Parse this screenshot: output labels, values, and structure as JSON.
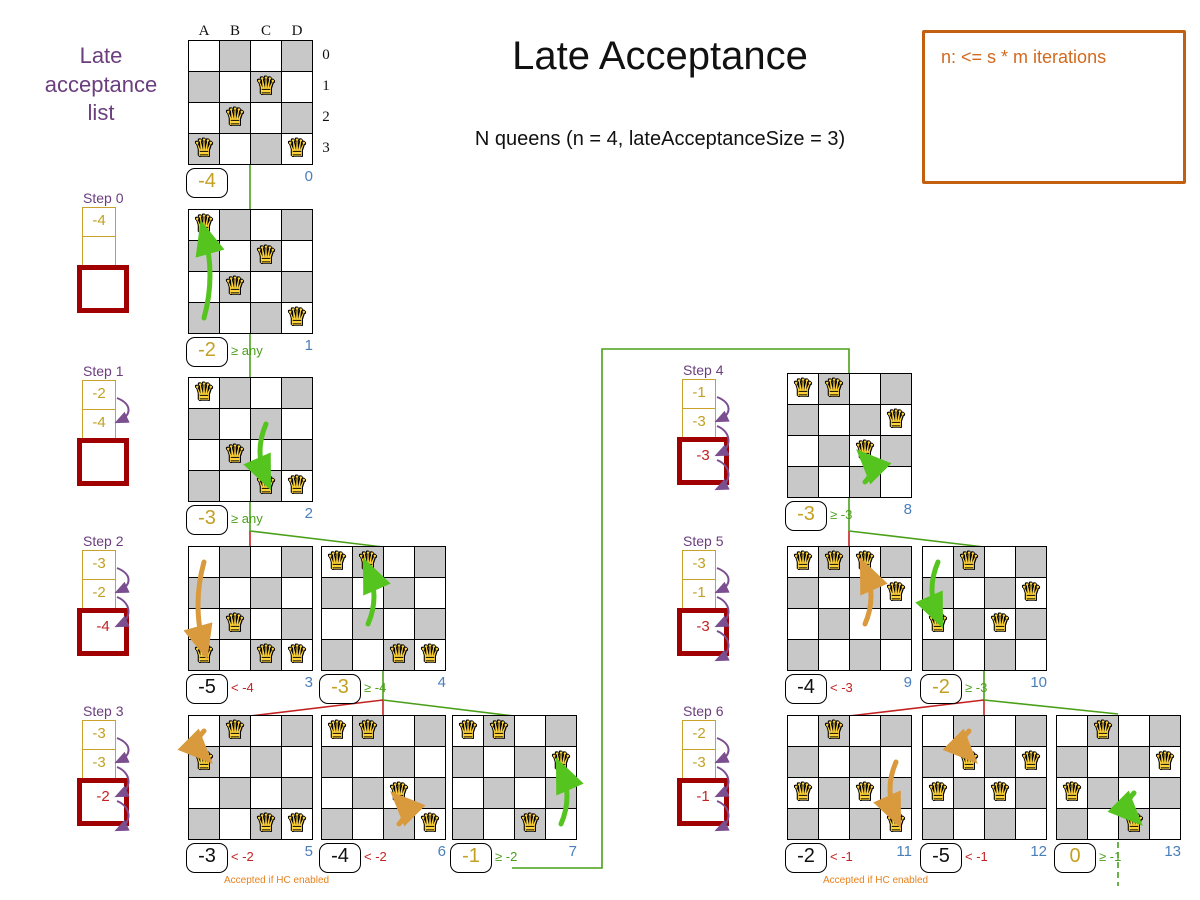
{
  "title": "Late Acceptance",
  "subtitle": "N queens (n = 4, lateAcceptanceSize = 3)",
  "note_box": "n: <= s * m iterations",
  "list_title": "Late acceptance list",
  "board_axis": {
    "cols": [
      "A",
      "B",
      "C",
      "D"
    ],
    "rows": [
      "0",
      "1",
      "2",
      "3"
    ]
  },
  "colors": {
    "purple": "#7b4f8f",
    "gold": "#c3a021",
    "line_green": "#4aa019",
    "line_red": "#c42222",
    "move_green": "#55c41f",
    "move_orange": "#d99a3e",
    "late_box_border": "#a00000",
    "index_blue": "#4a7ebb",
    "note_orange": "#e8821e",
    "box_orange": "#c3600f",
    "cell_gray": "#c8c8c8"
  },
  "steps": [
    {
      "label": "Step 0",
      "x": 82,
      "y": 190,
      "cells": [
        "-4",
        ""
      ],
      "late": "",
      "arrows": 0
    },
    {
      "label": "Step 1",
      "x": 82,
      "y": 363,
      "cells": [
        "-2",
        "-4"
      ],
      "late": "",
      "arrows": 1
    },
    {
      "label": "Step 2",
      "x": 82,
      "y": 533,
      "cells": [
        "-3",
        "-2"
      ],
      "late": "-4",
      "arrows": 2
    },
    {
      "label": "Step 3",
      "x": 82,
      "y": 703,
      "cells": [
        "-3",
        "-3"
      ],
      "late": "-2",
      "arrows": 3
    },
    {
      "label": "Step 4",
      "x": 682,
      "y": 362,
      "cells": [
        "-1",
        "-3"
      ],
      "late": "-3",
      "arrows": 3
    },
    {
      "label": "Step 5",
      "x": 682,
      "y": 533,
      "cells": [
        "-3",
        "-1"
      ],
      "late": "-3",
      "arrows": 3
    },
    {
      "label": "Step 6",
      "x": 682,
      "y": 703,
      "cells": [
        "-2",
        "-3"
      ],
      "late": "-1",
      "arrows": 3
    }
  ],
  "boards": [
    {
      "index": "0",
      "x": 188,
      "y": 40,
      "queens": [
        "C1",
        "B2",
        "A3",
        "D3"
      ],
      "score": "-4",
      "score_style": "gold",
      "compare": "",
      "compare_style": "",
      "axis": true
    },
    {
      "index": "1",
      "x": 188,
      "y": 209,
      "queens": [
        "A0",
        "C1",
        "B2",
        "D3"
      ],
      "score": "-2",
      "score_style": "gold",
      "compare": "≥ any",
      "compare_style": "green",
      "move": {
        "from": "A3",
        "to": "A0",
        "color": "green"
      }
    },
    {
      "index": "2",
      "x": 188,
      "y": 377,
      "queens": [
        "A0",
        "B2",
        "C3",
        "D3"
      ],
      "score": "-3",
      "score_style": "gold",
      "compare": "≥ any",
      "compare_style": "green",
      "move": {
        "from": "C1",
        "to": "C3",
        "color": "green"
      }
    },
    {
      "index": "3",
      "x": 188,
      "y": 546,
      "queens": [
        "B2",
        "A3",
        "C3",
        "D3"
      ],
      "score": "-5",
      "score_style": "black",
      "compare": "< -4",
      "compare_style": "red",
      "move": {
        "from": "A0",
        "to": "A3",
        "color": "orange"
      }
    },
    {
      "index": "4",
      "x": 321,
      "y": 546,
      "queens": [
        "A0",
        "B0",
        "C3",
        "D3"
      ],
      "score": "-3",
      "score_style": "gold",
      "compare": "≥ -4",
      "compare_style": "green",
      "move": {
        "from": "B2",
        "to": "B0",
        "color": "green"
      }
    },
    {
      "index": "5",
      "x": 188,
      "y": 715,
      "queens": [
        "B0",
        "A1",
        "C3",
        "D3"
      ],
      "score": "-3",
      "score_style": "black",
      "compare": "< -2",
      "compare_style": "red",
      "note": "Accepted if HC enabled",
      "move": {
        "from": "A0",
        "to": "A1",
        "color": "orange"
      }
    },
    {
      "index": "6",
      "x": 321,
      "y": 715,
      "queens": [
        "A0",
        "B0",
        "C2",
        "D3"
      ],
      "score": "-4",
      "score_style": "black",
      "compare": "< -2",
      "compare_style": "red",
      "move": {
        "from": "C3",
        "to": "C2",
        "color": "orange"
      }
    },
    {
      "index": "7",
      "x": 452,
      "y": 715,
      "queens": [
        "A0",
        "B0",
        "D1",
        "C3"
      ],
      "score": "-1",
      "score_style": "gold",
      "compare": "≥ -2",
      "compare_style": "green",
      "move": {
        "from": "D3",
        "to": "D1",
        "color": "green"
      }
    },
    {
      "index": "8",
      "x": 787,
      "y": 373,
      "queens": [
        "A0",
        "B0",
        "D1",
        "C2"
      ],
      "score": "-3",
      "score_style": "gold",
      "compare": "≥ -3",
      "compare_style": "green",
      "move": {
        "from": "C3",
        "to": "C2",
        "color": "green"
      }
    },
    {
      "index": "9",
      "x": 787,
      "y": 546,
      "queens": [
        "A0",
        "B0",
        "C0",
        "D1"
      ],
      "score": "-4",
      "score_style": "black",
      "compare": "< -3",
      "compare_style": "red",
      "move": {
        "from": "C2",
        "to": "C0",
        "color": "orange"
      }
    },
    {
      "index": "10",
      "x": 922,
      "y": 546,
      "queens": [
        "B0",
        "D1",
        "A2",
        "C2"
      ],
      "score": "-2",
      "score_style": "gold",
      "compare": "≥ -3",
      "compare_style": "green",
      "move": {
        "from": "A0",
        "to": "A2",
        "color": "green"
      }
    },
    {
      "index": "11",
      "x": 787,
      "y": 715,
      "queens": [
        "B0",
        "A2",
        "C2",
        "D3"
      ],
      "score": "-2",
      "score_style": "black",
      "compare": "< -1",
      "compare_style": "red",
      "note": "Accepted if HC enabled",
      "move": {
        "from": "D1",
        "to": "D3",
        "color": "orange"
      }
    },
    {
      "index": "12",
      "x": 922,
      "y": 715,
      "queens": [
        "B1",
        "D1",
        "A2",
        "C2"
      ],
      "score": "-5",
      "score_style": "black",
      "compare": "< -1",
      "compare_style": "red",
      "move": {
        "from": "B0",
        "to": "B1",
        "color": "orange"
      }
    },
    {
      "index": "13",
      "x": 1056,
      "y": 715,
      "queens": [
        "B0",
        "D1",
        "A2",
        "C3"
      ],
      "score": "0",
      "score_style": "gold",
      "compare": "≥ -1",
      "compare_style": "green",
      "move": {
        "from": "C2",
        "to": "C3",
        "color": "green"
      }
    }
  ],
  "connectors": [
    {
      "color": "green",
      "points": [
        [
          250,
          165
        ],
        [
          250,
          210
        ]
      ]
    },
    {
      "color": "green",
      "points": [
        [
          250,
          334
        ],
        [
          250,
          378
        ]
      ]
    },
    {
      "color": "green",
      "points": [
        [
          250,
          502
        ],
        [
          250,
          531
        ]
      ]
    },
    {
      "color": "red",
      "points": [
        [
          250,
          531
        ],
        [
          250,
          547
        ]
      ]
    },
    {
      "color": "green",
      "points": [
        [
          250,
          531
        ],
        [
          383,
          547
        ]
      ]
    },
    {
      "color": "green",
      "points": [
        [
          383,
          671
        ],
        [
          383,
          700
        ]
      ]
    },
    {
      "color": "red",
      "points": [
        [
          383,
          700
        ],
        [
          250,
          716
        ]
      ]
    },
    {
      "color": "red",
      "points": [
        [
          383,
          700
        ],
        [
          383,
          716
        ]
      ]
    },
    {
      "color": "green",
      "points": [
        [
          383,
          700
        ],
        [
          514,
          716
        ]
      ]
    },
    {
      "color": "green",
      "points": [
        [
          512,
          868
        ],
        [
          602,
          868
        ],
        [
          602,
          349
        ],
        [
          849,
          349
        ],
        [
          849,
          374
        ]
      ]
    },
    {
      "color": "green",
      "points": [
        [
          849,
          498
        ],
        [
          849,
          531
        ]
      ]
    },
    {
      "color": "red",
      "points": [
        [
          849,
          531
        ],
        [
          849,
          547
        ]
      ]
    },
    {
      "color": "green",
      "points": [
        [
          849,
          531
        ],
        [
          984,
          547
        ]
      ]
    },
    {
      "color": "green",
      "points": [
        [
          984,
          671
        ],
        [
          984,
          700
        ]
      ]
    },
    {
      "color": "red",
      "points": [
        [
          984,
          700
        ],
        [
          849,
          716
        ]
      ]
    },
    {
      "color": "red",
      "points": [
        [
          984,
          700
        ],
        [
          984,
          716
        ]
      ]
    },
    {
      "color": "green",
      "points": [
        [
          984,
          700
        ],
        [
          1118,
          714
        ]
      ]
    },
    {
      "color": "green",
      "dashed": true,
      "points": [
        [
          1118,
          842
        ],
        [
          1118,
          886
        ]
      ]
    }
  ]
}
